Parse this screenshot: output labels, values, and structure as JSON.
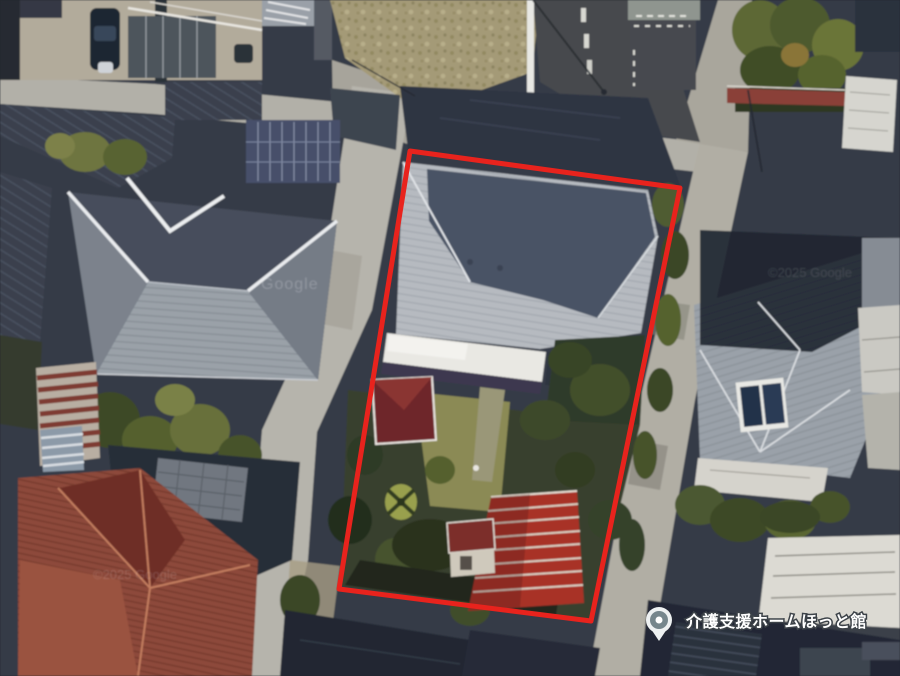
{
  "map": {
    "view": "satellite",
    "marker": {
      "label": "介護支援ホームほっと館",
      "pin_fill_color": "#76868c",
      "pin_ring_color": "#eef1f2",
      "pin_dot_color": "#ffffff"
    },
    "highlight": {
      "shape": "quadrilateral",
      "color": "#e8231d"
    },
    "provider_watermarks": {
      "google_center": "Google",
      "copyright_left": "©2025 Google",
      "copyright_right": "©2025 Google"
    }
  }
}
